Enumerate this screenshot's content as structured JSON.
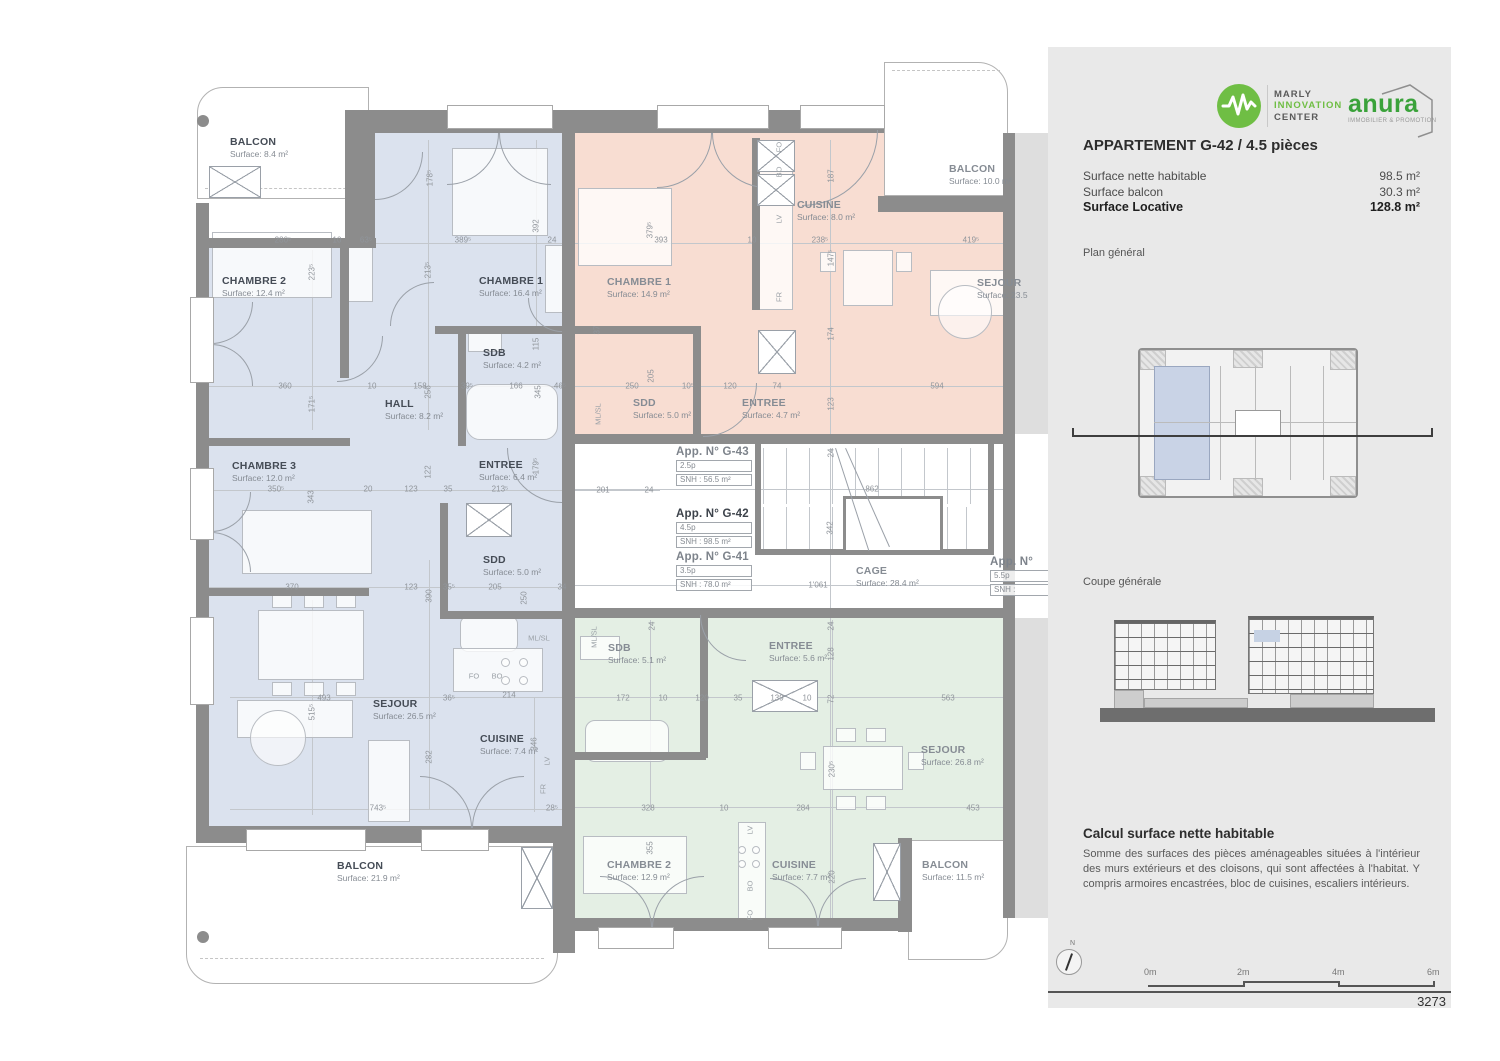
{
  "sidebar": {
    "marly": {
      "line1": "MARLY",
      "line2": "INNOVATION",
      "line3": "CENTER"
    },
    "anura": {
      "name": "anura",
      "tagline": "IMMOBILIER & PROMOTION"
    },
    "title": "APPARTEMENT G-42 / 4.5 pièces",
    "stats": [
      {
        "label": "Surface nette habitable",
        "value": "98.5 m²"
      },
      {
        "label": "Surface balcon",
        "value": "30.3 m²"
      },
      {
        "label": "Surface Locative",
        "value": "128.8 m²",
        "bold": true
      }
    ],
    "plan_general_label": "Plan général",
    "coupe_label": "Coupe générale",
    "calc": {
      "title": "Calcul surface nette habitable",
      "body": "Somme des surfaces des pièces aménageables situées à l'intérieur des murs extérieurs et des cloisons, qui sont affectées à l'habitat. Y compris armoires encastrées, bloc de cuisines, escaliers intérieurs."
    },
    "north_label": "N",
    "scale": [
      "0m",
      "2m",
      "4m",
      "6m"
    ],
    "sheet_number": "3273"
  },
  "plan": {
    "rooms": [
      {
        "title": "BALCON",
        "sub": "Surface: 8.4 m²",
        "x": 230,
        "y": 137
      },
      {
        "title": "CHAMBRE 2",
        "sub": "Surface: 12.4 m²",
        "x": 222,
        "y": 276
      },
      {
        "title": "CHAMBRE 1",
        "sub": "Surface: 16.4 m²",
        "x": 479,
        "y": 276
      },
      {
        "title": "SDB",
        "sub": "Surface: 4.2 m²",
        "x": 483,
        "y": 348
      },
      {
        "title": "HALL",
        "sub": "Surface: 8.2 m²",
        "x": 385,
        "y": 399
      },
      {
        "title": "CHAMBRE 3",
        "sub": "Surface: 12.0 m²",
        "x": 232,
        "y": 461
      },
      {
        "title": "ENTREE",
        "sub": "Surface: 6.4 m²",
        "x": 479,
        "y": 460
      },
      {
        "title": "SDD",
        "sub": "Surface: 5.0 m²",
        "x": 483,
        "y": 555
      },
      {
        "title": "SEJOUR",
        "sub": "Surface: 26.5 m²",
        "x": 373,
        "y": 699
      },
      {
        "title": "CUISINE",
        "sub": "Surface: 7.4 m²",
        "x": 480,
        "y": 734
      },
      {
        "title": "BALCON",
        "sub": "Surface: 21.9 m²",
        "x": 337,
        "y": 861
      },
      {
        "title": "CHAMBRE 1",
        "sub": "Surface: 14.9 m²",
        "x": 607,
        "y": 277,
        "muted": true
      },
      {
        "title": "CUISINE",
        "sub": "Surface: 8.0 m²",
        "x": 797,
        "y": 200,
        "muted": true
      },
      {
        "title": "BALCON",
        "sub": "Surface: 10.0 m²",
        "x": 949,
        "y": 164,
        "muted": true
      },
      {
        "title": "SDD",
        "sub": "Surface: 5.0 m²",
        "x": 633,
        "y": 398,
        "muted": true
      },
      {
        "title": "ENTREE",
        "sub": "Surface: 4.7 m²",
        "x": 742,
        "y": 398,
        "muted": true
      },
      {
        "title": "SEJOUR",
        "sub": "Surface: 23.5",
        "x": 977,
        "y": 278,
        "muted": true
      },
      {
        "title": "CAGE",
        "sub": "Surface: 28.4 m²",
        "x": 856,
        "y": 566,
        "muted": true
      },
      {
        "title": "SDB",
        "sub": "Surface: 5.1 m²",
        "x": 608,
        "y": 643,
        "muted": true
      },
      {
        "title": "ENTREE",
        "sub": "Surface: 5.6 m²",
        "x": 769,
        "y": 641,
        "muted": true
      },
      {
        "title": "SEJOUR",
        "sub": "Surface: 26.8 m²",
        "x": 921,
        "y": 745,
        "muted": true
      },
      {
        "title": "CHAMBRE 2",
        "sub": "Surface: 12.9 m²",
        "x": 607,
        "y": 860,
        "muted": true
      },
      {
        "title": "CUISINE",
        "sub": "Surface: 7.7 m²",
        "x": 772,
        "y": 860,
        "muted": true
      },
      {
        "title": "BALCON",
        "sub": "Surface: 11.5 m²",
        "x": 922,
        "y": 860,
        "muted": true
      }
    ],
    "apartments": [
      {
        "title": "App. N° G-43",
        "rooms": "2.5p",
        "snh": "SNH : 56.5 m²",
        "x": 676,
        "y": 446
      },
      {
        "title": "App. N° G-42",
        "rooms": "4.5p",
        "snh": "SNH : 98.5 m²",
        "x": 676,
        "y": 508,
        "bold": true
      },
      {
        "title": "App. N° G-41",
        "rooms": "3.5p",
        "snh": "SNH : 78.0 m²",
        "x": 676,
        "y": 551
      },
      {
        "title": "App. N°",
        "rooms": "5.5p",
        "snh": "SNH :",
        "x": 990,
        "y": 556
      }
    ],
    "dims": [
      {
        "t": "280⁵",
        "x": 283,
        "y": 240
      },
      {
        "t": "10",
        "x": 337,
        "y": 240
      },
      {
        "t": "63⁵",
        "x": 366,
        "y": 240
      },
      {
        "t": "389⁵",
        "x": 463,
        "y": 240
      },
      {
        "t": "24",
        "x": 552,
        "y": 240
      },
      {
        "t": "393",
        "x": 661,
        "y": 240
      },
      {
        "t": "10",
        "x": 752,
        "y": 240
      },
      {
        "t": "238⁵",
        "x": 820,
        "y": 240
      },
      {
        "t": "419⁵",
        "x": 971,
        "y": 240
      },
      {
        "t": "360",
        "x": 285,
        "y": 386
      },
      {
        "t": "10",
        "x": 372,
        "y": 386
      },
      {
        "t": "158",
        "x": 420,
        "y": 386
      },
      {
        "t": "39⁵",
        "x": 467,
        "y": 386
      },
      {
        "t": "166",
        "x": 516,
        "y": 386
      },
      {
        "t": "46⁵",
        "x": 560,
        "y": 386
      },
      {
        "t": "250",
        "x": 632,
        "y": 386
      },
      {
        "t": "10⁵",
        "x": 688,
        "y": 386
      },
      {
        "t": "120",
        "x": 730,
        "y": 386
      },
      {
        "t": "74",
        "x": 777,
        "y": 386
      },
      {
        "t": "594",
        "x": 937,
        "y": 386
      },
      {
        "t": "350⁵",
        "x": 276,
        "y": 489
      },
      {
        "t": "20",
        "x": 368,
        "y": 489
      },
      {
        "t": "123",
        "x": 411,
        "y": 489
      },
      {
        "t": "35",
        "x": 448,
        "y": 489
      },
      {
        "t": "213⁵",
        "x": 500,
        "y": 489
      },
      {
        "t": "201",
        "x": 603,
        "y": 490
      },
      {
        "t": "24",
        "x": 649,
        "y": 490
      },
      {
        "t": "862",
        "x": 872,
        "y": 489
      },
      {
        "t": "370",
        "x": 292,
        "y": 587
      },
      {
        "t": "123",
        "x": 411,
        "y": 587
      },
      {
        "t": "35⁵",
        "x": 449,
        "y": 587
      },
      {
        "t": "205",
        "x": 495,
        "y": 587
      },
      {
        "t": "34",
        "x": 562,
        "y": 587
      },
      {
        "t": "493",
        "x": 324,
        "y": 698
      },
      {
        "t": "36⁵",
        "x": 449,
        "y": 698
      },
      {
        "t": "214",
        "x": 509,
        "y": 695
      },
      {
        "t": "172",
        "x": 623,
        "y": 698
      },
      {
        "t": "10",
        "x": 663,
        "y": 698
      },
      {
        "t": "120",
        "x": 702,
        "y": 698
      },
      {
        "t": "35",
        "x": 738,
        "y": 698
      },
      {
        "t": "139",
        "x": 777,
        "y": 698
      },
      {
        "t": "10",
        "x": 807,
        "y": 698
      },
      {
        "t": "563",
        "x": 948,
        "y": 698
      },
      {
        "t": "743⁵",
        "x": 378,
        "y": 808
      },
      {
        "t": "28⁵",
        "x": 552,
        "y": 808
      },
      {
        "t": "328",
        "x": 648,
        "y": 808
      },
      {
        "t": "10",
        "x": 724,
        "y": 808
      },
      {
        "t": "284",
        "x": 803,
        "y": 808
      },
      {
        "t": "453",
        "x": 973,
        "y": 808
      },
      {
        "t": "1'061",
        "x": 818,
        "y": 585
      },
      {
        "t": "178⁵",
        "x": 430,
        "y": 178,
        "v": 1
      },
      {
        "t": "392",
        "x": 536,
        "y": 226,
        "v": 1
      },
      {
        "t": "223⁵",
        "x": 312,
        "y": 272,
        "v": 1
      },
      {
        "t": "213⁵",
        "x": 428,
        "y": 270,
        "v": 1
      },
      {
        "t": "379⁵",
        "x": 650,
        "y": 230,
        "v": 1
      },
      {
        "t": "187",
        "x": 831,
        "y": 176,
        "v": 1
      },
      {
        "t": "147⁵",
        "x": 831,
        "y": 258,
        "v": 1
      },
      {
        "t": "174",
        "x": 831,
        "y": 334,
        "v": 1
      },
      {
        "t": "123",
        "x": 831,
        "y": 404,
        "v": 1
      },
      {
        "t": "115",
        "x": 536,
        "y": 344,
        "v": 1
      },
      {
        "t": "179⁵",
        "x": 536,
        "y": 466,
        "v": 1
      },
      {
        "t": "171⁵",
        "x": 312,
        "y": 404,
        "v": 1
      },
      {
        "t": "256",
        "x": 428,
        "y": 392,
        "v": 1
      },
      {
        "t": "345",
        "x": 538,
        "y": 392,
        "v": 1
      },
      {
        "t": "343",
        "x": 311,
        "y": 497,
        "v": 1
      },
      {
        "t": "122",
        "x": 428,
        "y": 472,
        "v": 1
      },
      {
        "t": "205",
        "x": 651,
        "y": 376,
        "v": 1
      },
      {
        "t": "390",
        "x": 429,
        "y": 596,
        "v": 1
      },
      {
        "t": "250",
        "x": 524,
        "y": 598,
        "v": 1
      },
      {
        "t": "342",
        "x": 830,
        "y": 528,
        "v": 1
      },
      {
        "t": "24",
        "x": 831,
        "y": 453,
        "v": 1
      },
      {
        "t": "24",
        "x": 652,
        "y": 626,
        "v": 1
      },
      {
        "t": "24",
        "x": 831,
        "y": 626,
        "v": 1
      },
      {
        "t": "515⁵",
        "x": 312,
        "y": 712,
        "v": 1
      },
      {
        "t": "282",
        "x": 429,
        "y": 757,
        "v": 1
      },
      {
        "t": "346",
        "x": 534,
        "y": 744,
        "v": 1
      },
      {
        "t": "355",
        "x": 650,
        "y": 848,
        "v": 1
      },
      {
        "t": "220",
        "x": 832,
        "y": 877,
        "v": 1
      },
      {
        "t": "128",
        "x": 831,
        "y": 654,
        "v": 1
      },
      {
        "t": "72",
        "x": 831,
        "y": 699,
        "v": 1
      },
      {
        "t": "230⁵",
        "x": 832,
        "y": 769,
        "v": 1
      },
      {
        "t": "37",
        "x": 597,
        "y": 330,
        "v": 1
      }
    ],
    "smalls": [
      {
        "t": "FO",
        "x": 474,
        "y": 676
      },
      {
        "t": "BO",
        "x": 497,
        "y": 676
      },
      {
        "t": "LV",
        "x": 547,
        "y": 761,
        "v": 1
      },
      {
        "t": "FR",
        "x": 543,
        "y": 789,
        "v": 1
      },
      {
        "t": "ML/SL",
        "x": 539,
        "y": 638
      },
      {
        "t": "ML/SL",
        "x": 598,
        "y": 414,
        "v": 1
      },
      {
        "t": "ML/SL",
        "x": 594,
        "y": 637,
        "v": 1
      },
      {
        "t": "FO",
        "x": 779,
        "y": 147,
        "v": 1
      },
      {
        "t": "BO",
        "x": 779,
        "y": 172,
        "v": 1
      },
      {
        "t": "LV",
        "x": 779,
        "y": 219,
        "v": 1
      },
      {
        "t": "FR",
        "x": 779,
        "y": 297,
        "v": 1
      },
      {
        "t": "LV",
        "x": 750,
        "y": 830,
        "v": 1
      },
      {
        "t": "BO",
        "x": 750,
        "y": 886,
        "v": 1
      },
      {
        "t": "FO",
        "x": 750,
        "y": 915,
        "v": 1
      }
    ]
  },
  "colors": {
    "accent_green": "#6fbe44",
    "anura_green": "#3aa23a",
    "apt_blue": "#dbe2ee",
    "apt_pink": "#f8ddd2",
    "apt_green": "#e4efe4",
    "wall_gray": "#8c8c8c",
    "panel_bg": "#e9e9e9"
  }
}
